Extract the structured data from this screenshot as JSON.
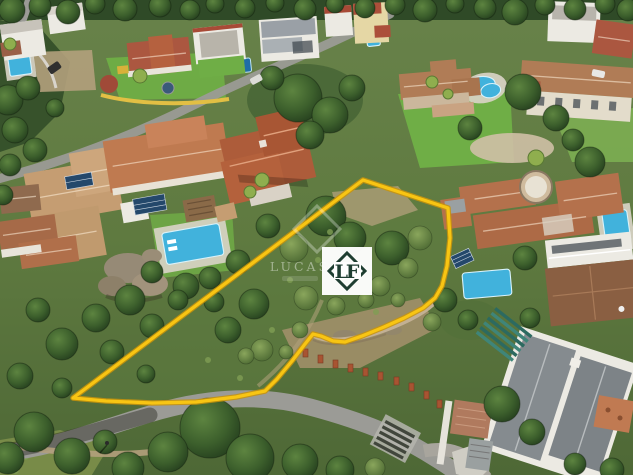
{
  "image": {
    "kind": "aerial drone photograph",
    "subject": "Residential neighborhood with a building plot for sale outlined in yellow",
    "width_px": 633,
    "height_px": 475
  },
  "plot_highlight": {
    "outline_color": "#f8c513",
    "outline_shade": "#c9940a"
  },
  "watermark": {
    "logo_letters": "LF",
    "brand_text": "LUCAS",
    "logo_color": "#1e3d31",
    "badge_bg": "#fefefe"
  },
  "colors": {
    "accent_yellow": "#f8c513",
    "accent_yellow_shade": "#c9940a",
    "brand_green": "#1e3d31",
    "pool_blue": "#41b2dc",
    "pool_deep": "#1f6da6",
    "roof_terracotta": "#b4613c",
    "roof_tan": "#c59d72",
    "roof_red": "#ab5740",
    "roof_gray": "#868c90",
    "roof_stone": "#b07c56",
    "wall_white": "#eceae3",
    "road_gray": "#9b9b96",
    "dirt_tan": "#b3a07c",
    "lawn_green": "#6fae46",
    "grass_base": "#61793f",
    "tree_dark": "#2f4a27",
    "scrub_green": "#6b8a48",
    "rock_gray": "#968a76"
  }
}
